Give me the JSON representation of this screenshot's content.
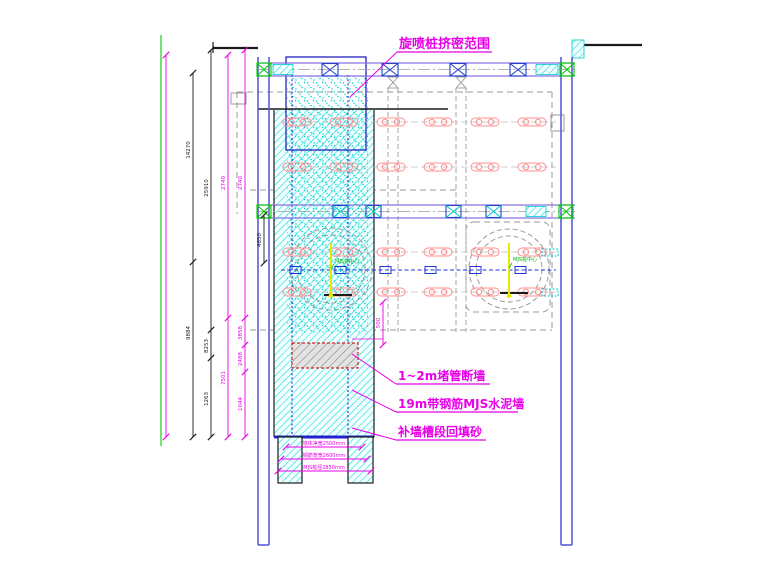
{
  "drawing": {
    "annotations": {
      "top_label": "旋喷桩挤密范围",
      "callout_plug_wall": "1~2m堵管断墙",
      "callout_mjs_wall": "19m带钢筋MJS水泥墙",
      "callout_backfill": "补墙槽段回填砂",
      "pile_center_left": "MJS桩中心",
      "pile_center_right": "MJS桩中心"
    },
    "dimensions": {
      "left": {
        "a": "14270",
        "b": "25910",
        "c": "2740",
        "d": "2740",
        "e": "9884",
        "f": "8253",
        "g": "1263",
        "h": "7501",
        "i": "3858",
        "j": "2488",
        "k": "1044"
      },
      "strut_gap": "4850",
      "pit_small": "500",
      "bottom": {
        "clear_width": "墙体净宽2500mm",
        "cage_width": "钢筋笼宽2600mm",
        "pile_dia": "MJS桩径2850mm"
      }
    },
    "colors": {
      "annotation_magenta": "#e800e8",
      "wall_blue": "#5b5bd5",
      "reinforce_cyan": "#00d8d8",
      "benchmark_green": "#00b400",
      "pile_red": "#ff8f8f",
      "marker_yellow": "#e8e800"
    }
  }
}
